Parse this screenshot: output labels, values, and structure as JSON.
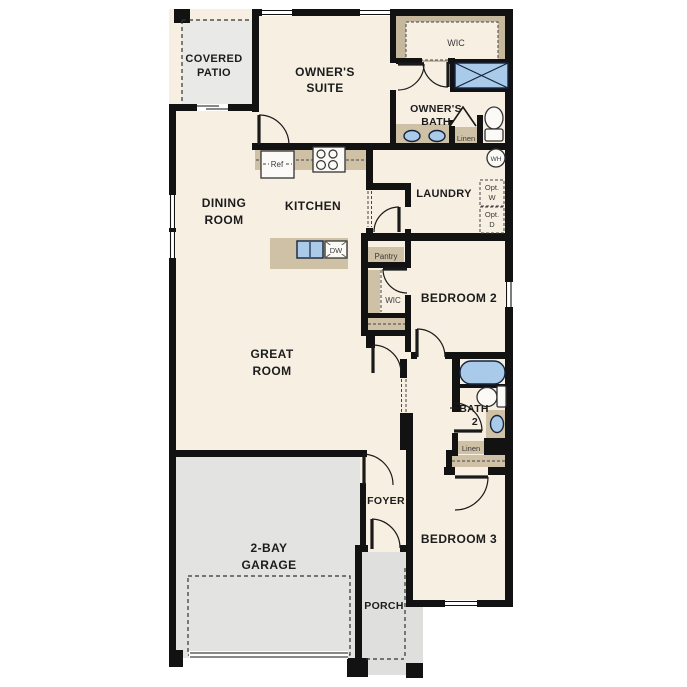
{
  "colors": {
    "wall": "#121212",
    "interior": "#f6efe2",
    "patio_gray": "#e9e9e7",
    "garage_gray": "#e3e3e1",
    "porch_gray": "#dfdfdd",
    "counter_tan": "#cfc1a5",
    "closet_tan": "#c6b89c",
    "fixture_blue": "#a9cbe9",
    "fixture_outline": "#16233d",
    "opt_box_gray": "#e7e7e3",
    "text_dark": "#1c1c1c",
    "text_small": "#3a3a3a"
  },
  "rooms": {
    "covered_patio": [
      "COVERED",
      "PATIO"
    ],
    "owners_suite": [
      "OWNER'S",
      "SUITE"
    ],
    "owners_bath": [
      "OWNER'S",
      "BATH"
    ],
    "dining_room": [
      "DINING",
      "ROOM"
    ],
    "kitchen": "KITCHEN",
    "laundry": "LAUNDRY",
    "great_room": [
      "GREAT",
      "ROOM"
    ],
    "bedroom2": "BEDROOM 2",
    "bath2": [
      "BATH",
      "2"
    ],
    "bedroom3": "BEDROOM 3",
    "foyer": "FOYER",
    "garage": [
      "2-BAY",
      "GARAGE"
    ],
    "porch": "PORCH"
  },
  "closets": {
    "wic_owner": "WIC",
    "wic_bedroom2": "WIC",
    "linen_owner": "Linen",
    "linen_bath2": "Linen",
    "pantry": "Pantry"
  },
  "appliances": {
    "refrigerator": "Ref",
    "dishwasher": "DW",
    "water_heater": "WH",
    "opt_washer": [
      "Opt.",
      "W"
    ],
    "opt_dryer": [
      "Opt.",
      "D"
    ]
  }
}
